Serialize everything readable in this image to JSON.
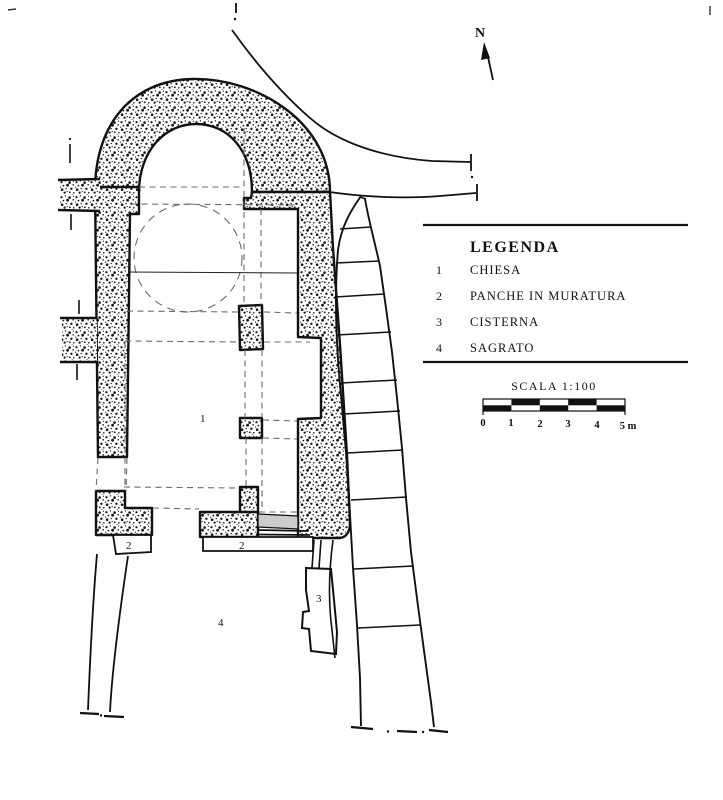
{
  "north": {
    "label": "N"
  },
  "legend": {
    "title": "LEGENDA",
    "items": [
      {
        "num": "1",
        "label": "CHIESA"
      },
      {
        "num": "2",
        "label": "PANCHE IN MURATURA"
      },
      {
        "num": "3",
        "label": "CISTERNA"
      },
      {
        "num": "4",
        "label": "SAGRATO"
      }
    ]
  },
  "scale": {
    "label": "SCALA 1:100",
    "ticks": [
      "0",
      "1",
      "2",
      "3",
      "4",
      "5 m"
    ]
  },
  "plan_labels": {
    "chiesa": "1",
    "bench_left": "2",
    "bench_right": "2",
    "cisterna": "3",
    "sagrato": "4"
  },
  "colors": {
    "paper": "#ffffff",
    "ink": "#111111",
    "dash": "#6b6b6b",
    "gray_fill": "#cccccc"
  }
}
